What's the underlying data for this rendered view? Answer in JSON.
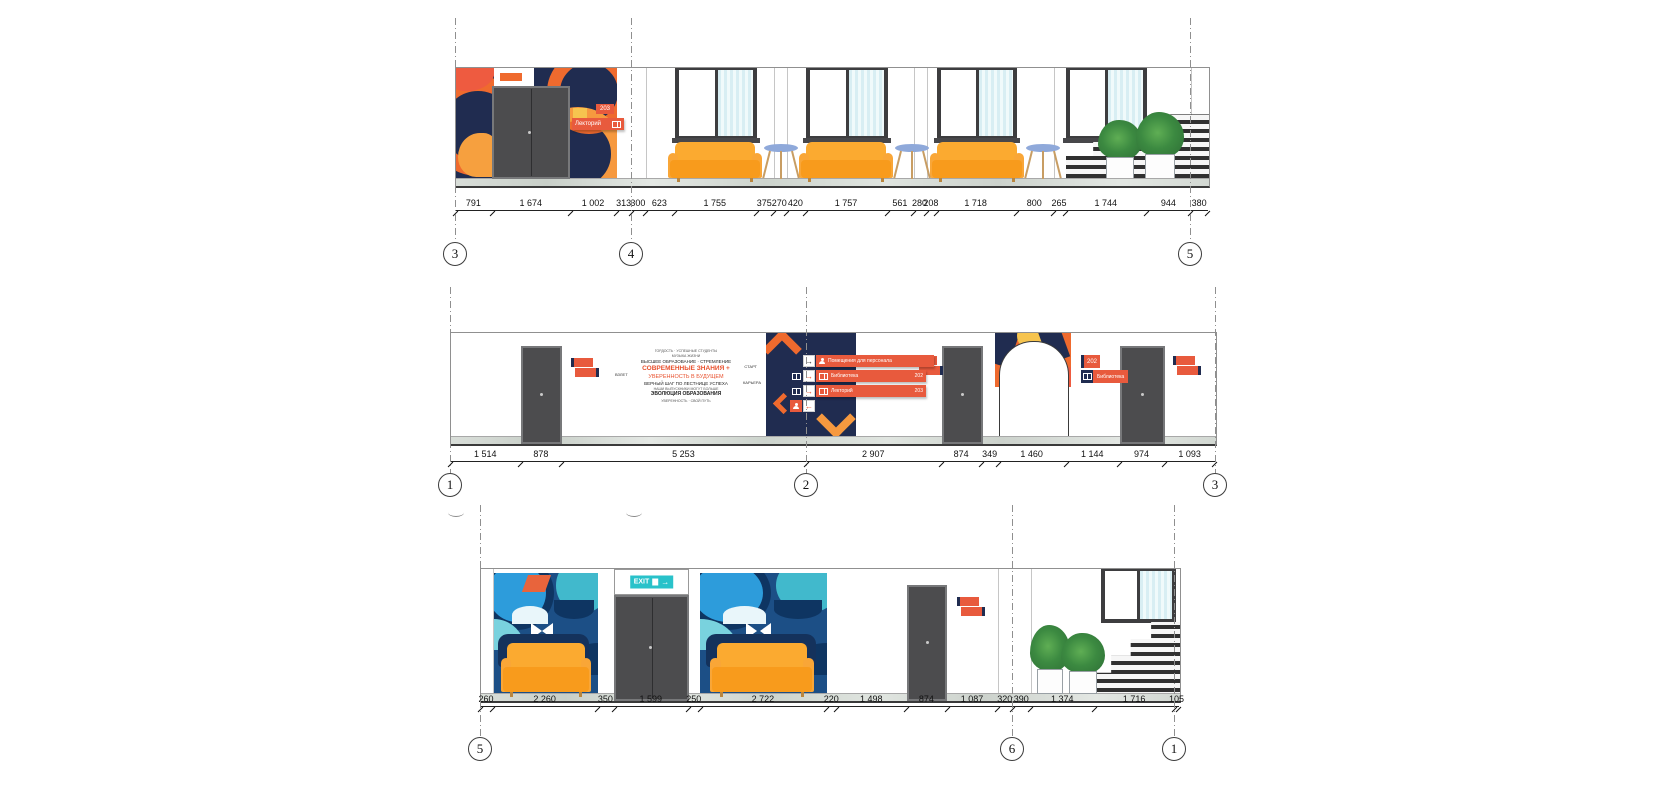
{
  "colors": {
    "accent_orange": "#ef6a2e",
    "accent_navy": "#202c50",
    "sign_red": "#e85a3d",
    "sofa_orange": "#f89b1c",
    "exit_teal": "#29c2ca",
    "table_blue": "#8fa9da"
  },
  "icons": {
    "arrow_right": "→",
    "arrow_left": "←"
  },
  "elevations": [
    {
      "id": "top",
      "grid_markers": [
        {
          "label": "3"
        },
        {
          "label": "4"
        },
        {
          "label": "5"
        }
      ],
      "dimensions": [
        {
          "label": "791",
          "mm": 791
        },
        {
          "label": "1 674",
          "mm": 1674
        },
        {
          "label": "1 002",
          "mm": 1002
        },
        {
          "label": "313",
          "mm": 313
        },
        {
          "label": "300",
          "mm": 300
        },
        {
          "label": "623",
          "mm": 623
        },
        {
          "label": "1 755",
          "mm": 1755
        },
        {
          "label": "375",
          "mm": 375
        },
        {
          "label": "270",
          "mm": 270
        },
        {
          "label": "420",
          "mm": 420
        },
        {
          "label": "1 757",
          "mm": 1757
        },
        {
          "label": "561",
          "mm": 561
        },
        {
          "label": "280",
          "mm": 280
        },
        {
          "label": "208",
          "mm": 208
        },
        {
          "label": "1 718",
          "mm": 1718
        },
        {
          "label": "800",
          "mm": 800
        },
        {
          "label": "265",
          "mm": 265
        },
        {
          "label": "1 744",
          "mm": 1744
        },
        {
          "label": "944",
          "mm": 944
        },
        {
          "label": "380",
          "mm": 380
        }
      ],
      "room_sign": {
        "badge": "203",
        "label": "Лекторий"
      }
    },
    {
      "id": "middle",
      "grid_markers": [
        {
          "label": "1"
        },
        {
          "label": "2"
        },
        {
          "label": "3"
        }
      ],
      "dimensions": [
        {
          "label": "1 514",
          "mm": 1514
        },
        {
          "label": "878",
          "mm": 878
        },
        {
          "label": "5 253",
          "mm": 5253
        },
        {
          "label": "2 907",
          "mm": 2907
        },
        {
          "label": "874",
          "mm": 874
        },
        {
          "label": "349",
          "mm": 349
        },
        {
          "label": "1 460",
          "mm": 1460
        },
        {
          "label": "1 144",
          "mm": 1144
        },
        {
          "label": "974",
          "mm": 974
        },
        {
          "label": "1 093",
          "mm": 1093
        }
      ],
      "wayfinding_sign": {
        "rows": [
          {
            "label": "Помещения для персонала",
            "room": ""
          },
          {
            "label": "Библиотека",
            "room": "202"
          },
          {
            "label": "Лекторий",
            "room": "203"
          },
          {
            "label": "",
            "room": ""
          }
        ]
      },
      "arch_sign": {
        "room": "202",
        "label": "Библиотека"
      },
      "word_cloud": {
        "lines": [
          "ГОРДОСТЬ · УСПЕШНЫЕ СТУДЕНТЫ",
          "МУЗЫКА ЖИЗНИ",
          "ВЫСШЕЕ ОБРАЗОВАНИЕ · СТРЕМЛЕНИЕ",
          "СОВРЕМЕННЫЕ ЗНАНИЯ +",
          "УВЕРЕННОСТЬ В БУДУЩЕМ",
          "ВЕРНЫЙ ШАГ ПО ЛЕСТНИЦЕ УСПЕХА",
          "НАШИ ВЫПУСКНИКИ МОГУТ БОЛЬШЕ",
          "ЭВОЛЮЦИЯ ОБРАЗОВАНИЯ",
          "УВЕРЕННОСТЬ · СВОЙ ПУТЬ",
          "ВЗЛЕТ",
          "СТАРТ",
          "КАРЬЕРА"
        ]
      }
    },
    {
      "id": "bottom",
      "grid_markers": [
        {
          "label": "5"
        },
        {
          "label": "6"
        },
        {
          "label": "1"
        }
      ],
      "dimensions": [
        {
          "label": "260",
          "mm": 260
        },
        {
          "label": "2 260",
          "mm": 2260
        },
        {
          "label": "350",
          "mm": 350
        },
        {
          "label": "1 599",
          "mm": 1599
        },
        {
          "label": "250",
          "mm": 250
        },
        {
          "label": "2 722",
          "mm": 2722
        },
        {
          "label": "220",
          "mm": 220
        },
        {
          "label": "1 498",
          "mm": 1498
        },
        {
          "label": "874",
          "mm": 874
        },
        {
          "label": "1 087",
          "mm": 1087
        },
        {
          "label": "320",
          "mm": 320
        },
        {
          "label": "390",
          "mm": 390
        },
        {
          "label": "1 374",
          "mm": 1374
        },
        {
          "label": "1 716",
          "mm": 1716
        },
        {
          "label": "105",
          "mm": 105
        }
      ],
      "exit_sign": {
        "label": "EXIT"
      }
    }
  ]
}
